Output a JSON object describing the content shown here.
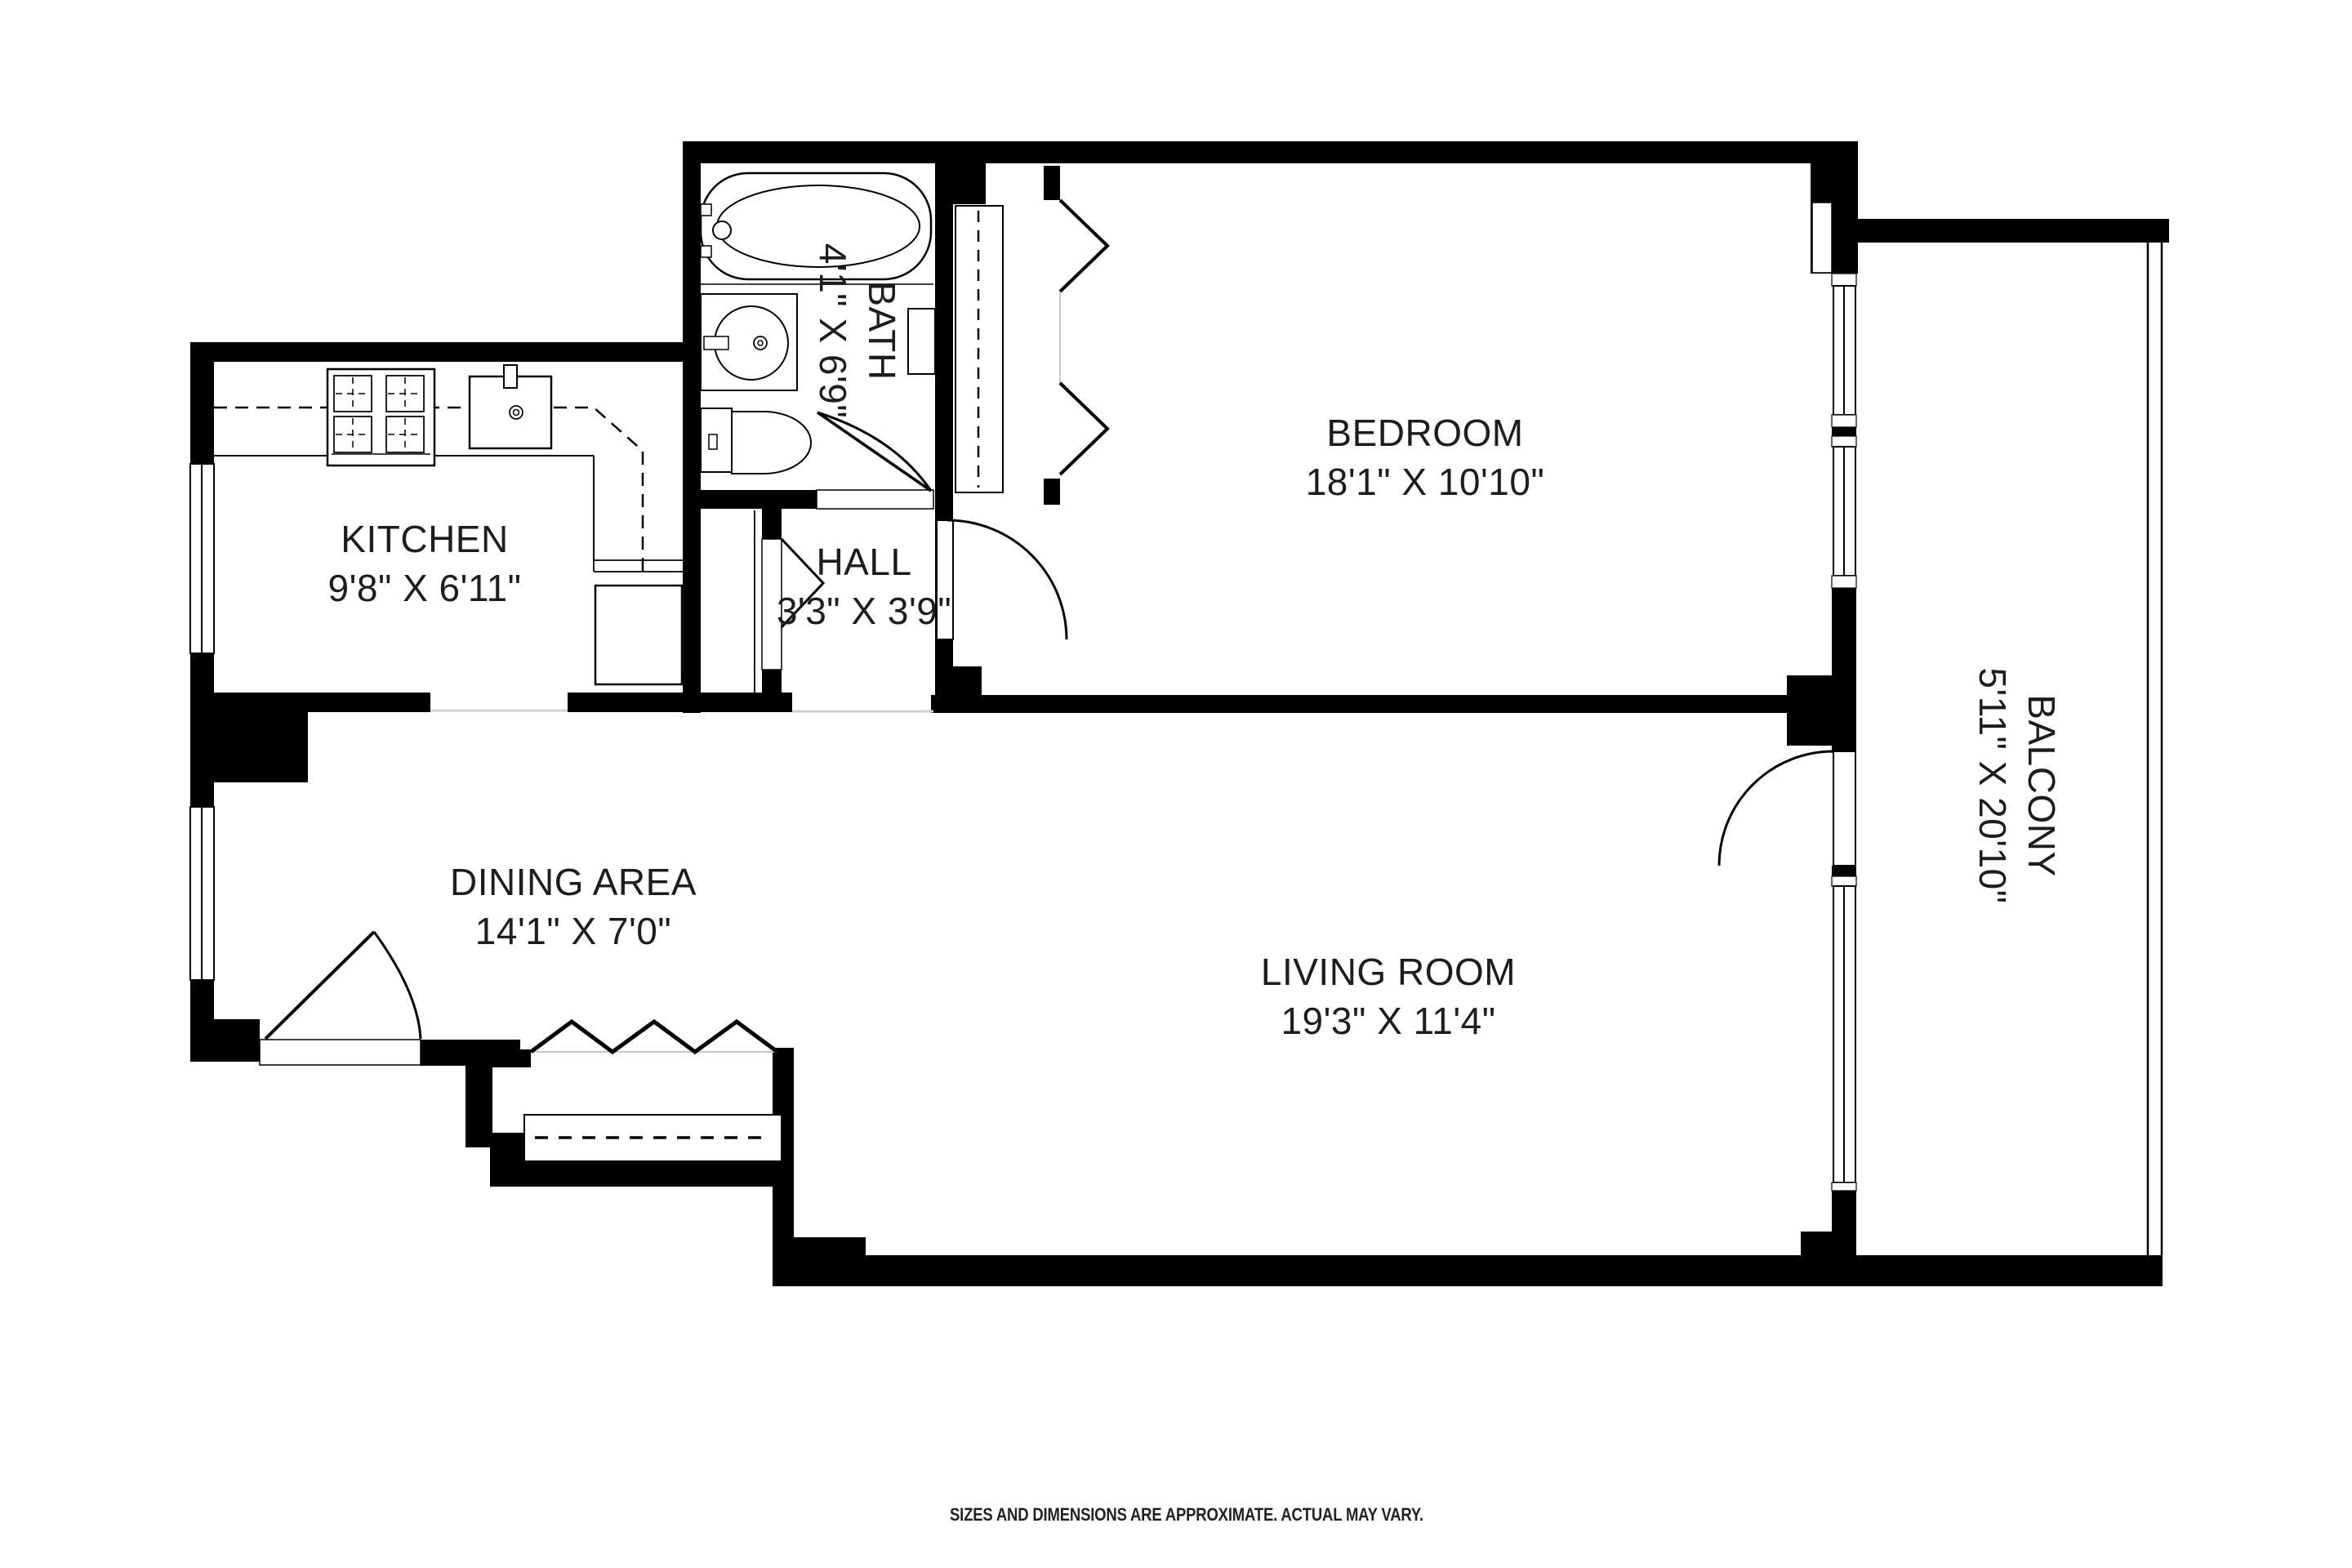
{
  "rooms": {
    "kitchen": {
      "name": "KITCHEN",
      "dims": "9'8\" X 6'11\""
    },
    "bath": {
      "name": "BATH",
      "dims": "4'1\" X 6'9\""
    },
    "hall": {
      "name": "HALL",
      "dims": "3'3\" X 3'9\""
    },
    "bedroom": {
      "name": "BEDROOM",
      "dims": "18'1\" X 10'10\""
    },
    "dining": {
      "name": "DINING AREA",
      "dims": "14'1\" X 7'0\""
    },
    "living": {
      "name": "LIVING ROOM",
      "dims": "19'3\" X 11'4\""
    },
    "balcony": {
      "name": "BALCONY",
      "dims": "5'11\" X 20'10\""
    }
  },
  "footer": {
    "disclaimer": "SIZES AND DIMENSIONS ARE APPROXIMATE. ACTUAL MAY VARY."
  },
  "colors": {
    "wall": "#000000",
    "background": "#ffffff",
    "threshold": "#cfcfcf"
  }
}
